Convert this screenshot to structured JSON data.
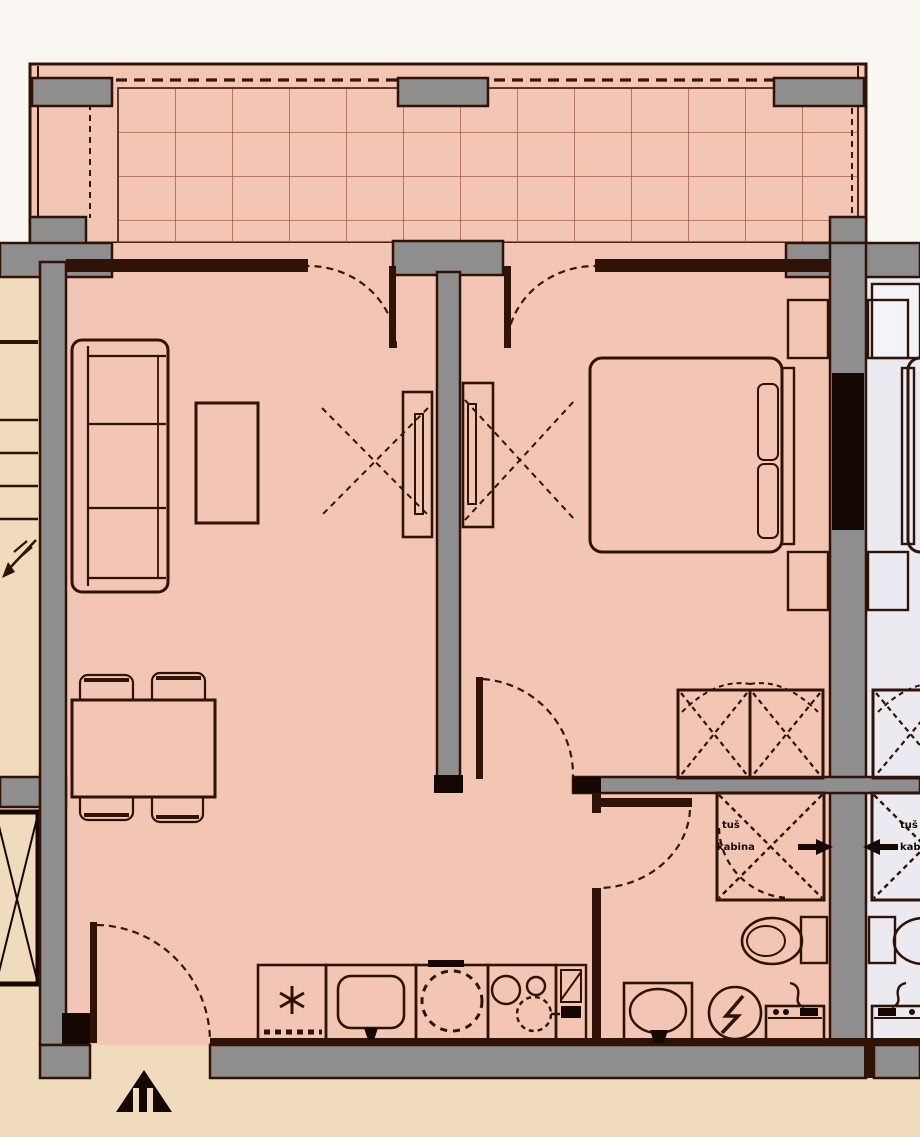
{
  "plan": {
    "type": "apartment floor plan (top-down architectural drawing)",
    "colors": {
      "apartment_floor_pink": "#f3c5b5",
      "neighbor_floor_gray": "#eaeaf0",
      "stairwell_beige": "#f1dbbd",
      "wall_fill_gray": "#8e8e8e",
      "line_dark_brown": "#2f1307",
      "solid_black": "#150802",
      "background_white": "#faf7f3",
      "tile_grid_line": "#a8604d"
    },
    "shower_label": {
      "line1": "tuš",
      "line2": "kabina"
    },
    "neighbor_shower_label": {
      "line1": "tuš",
      "line2": "kabina"
    },
    "rooms": [
      "terrace-balcony with tiled floor",
      "living room",
      "dining area",
      "kitchen along south wall",
      "bedroom",
      "bathroom",
      "entrance hall",
      "communal stairwell",
      "elevator shaft",
      "neighboring mirrored apartment (partially visible)"
    ],
    "furniture_fixtures": [
      "sofa",
      "coffee table",
      "tv cabinet living room",
      "tv cabinet bedroom",
      "dining table with four chairs",
      "double bed",
      "two nightstands",
      "two wardrobes with X marks",
      "fridge (snowflake icon)",
      "kitchen sink",
      "appliance with dotted drum circle",
      "cooktop burners",
      "tall kitchen cabinet",
      "shower cabin with X and pivot arc",
      "toilet with cistern",
      "washbasin",
      "water heater with lightning bolt",
      "washing machine with hose",
      "entrance door swing",
      "balcony door swings",
      "bedroom door swing",
      "bathroom door swing",
      "stairs direction arrow",
      "black entrance triangle marker"
    ]
  }
}
